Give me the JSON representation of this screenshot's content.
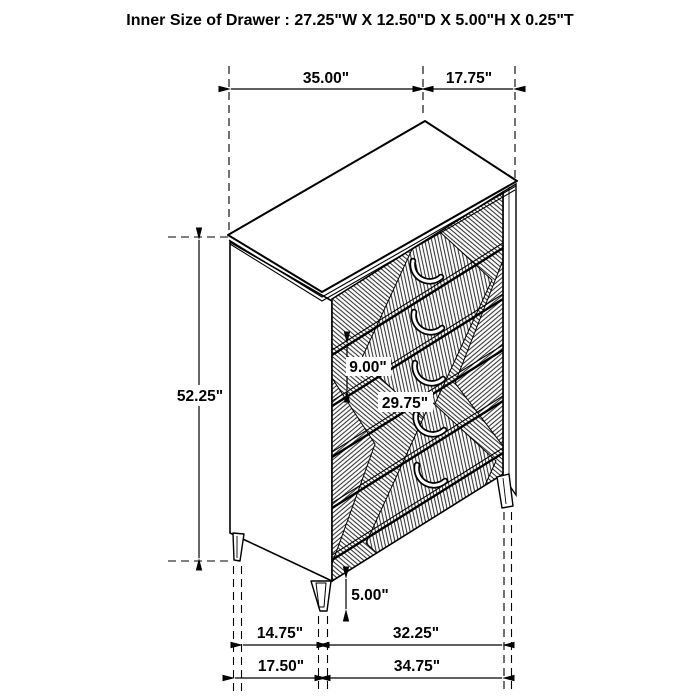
{
  "title": "Inner Size of Drawer : 27.25\"W X 12.50\"D X 5.00\"H X 0.25\"T",
  "furniture": {
    "drawer_count": 5
  },
  "colors": {
    "line": "#000000",
    "background": "#ffffff"
  },
  "dimensions": {
    "top_width": "35.00\"",
    "top_depth": "17.75\"",
    "overall_height": "52.25\"",
    "drawer_front_height": "9.00\"",
    "inner_width": "29.75\"",
    "leg_height": "5.00\"",
    "front_leg_span": "14.75\"",
    "side_leg_span": "32.25\"",
    "base_width": "17.50\"",
    "base_depth": "34.75\""
  }
}
